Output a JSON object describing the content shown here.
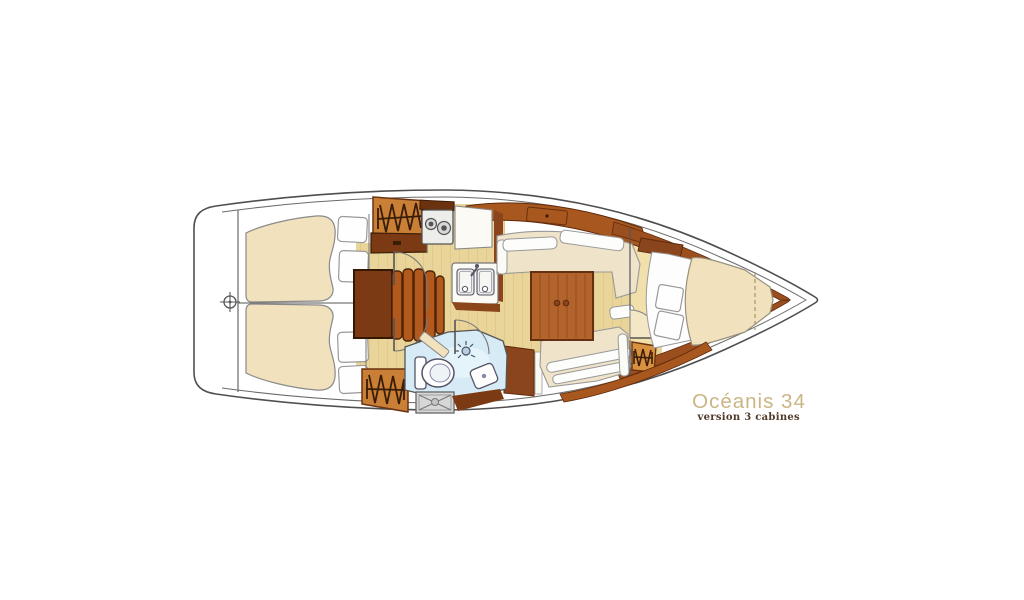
{
  "plan": {
    "brand_title": "Océanis 34",
    "brand_subtitle": "version 3 cabines"
  },
  "colors": {
    "hull_stroke": "#4f4f4f",
    "floor_khaki": "#e9d599",
    "floor_forward": "#f1e0ac",
    "mattress_cream": "#f1e1bc",
    "settee_cream": "#efe4c9",
    "wood_mid": "#a8571f",
    "wood_locker": "#c97f36",
    "wood_dark": "#7c3a14",
    "table_wood": "#b2642c",
    "head_blue": "#d6ebf6",
    "hatch_gray": "#d7d7d7",
    "title_gold": "#cbb583",
    "subtitle_brown": "#503a2a"
  },
  "icons": {
    "stern_datum": "crosshair",
    "wardrobe": "zigzag-hanger",
    "stove": "two-burner-stove",
    "galley_sink": "double-basin-sink",
    "toilet": "toilet-bowl",
    "shower": "shower-rose",
    "head_sink": "washbasin",
    "deck_hatch": "cross-braced-hatch",
    "companionway": "curved-steps",
    "door": "quarter-arc-swing",
    "table": "saloon-table"
  }
}
